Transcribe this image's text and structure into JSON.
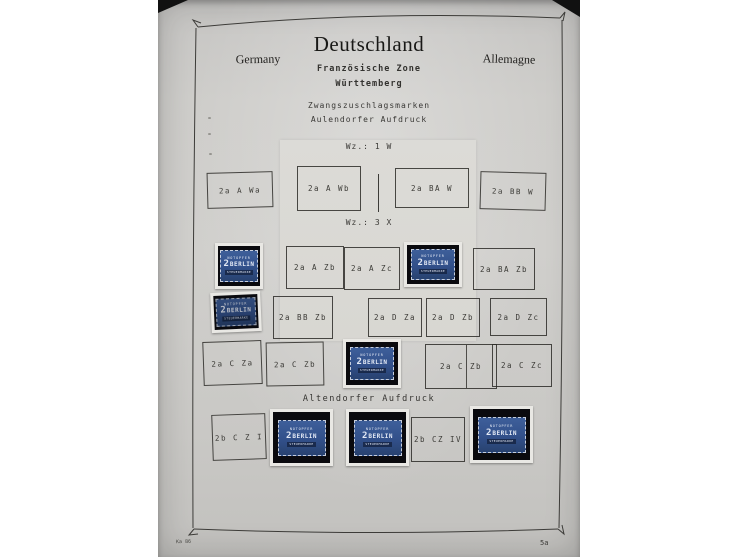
{
  "header": {
    "left_lang": "Germany",
    "title": "Deutschland",
    "right_lang": "Allemagne",
    "subtitle1": "Französische Zone",
    "subtitle2": "Württemberg"
  },
  "section": {
    "line1": "Zwangszuschlagsmarken",
    "line2": "Aulendorfer Aufdruck"
  },
  "watermark_labels": {
    "wm1": "Wz.: 1 W",
    "wm3": "Wz.: 3 X"
  },
  "altendorf_heading": "Altendorfer Aufdruck",
  "rows": {
    "r1": [
      {
        "type": "box",
        "label": "2a A Wa"
      },
      {
        "type": "box",
        "label": "2a A Wb"
      },
      {
        "type": "box",
        "label": "2a BA W"
      },
      {
        "type": "box",
        "label": "2a BB W"
      }
    ],
    "r2": [
      {
        "type": "stamp"
      },
      {
        "type": "box",
        "label": "2a A Zb"
      },
      {
        "type": "box",
        "label": "2a A Zc"
      },
      {
        "type": "stamp"
      },
      {
        "type": "box",
        "label": "2a BA Zb"
      }
    ],
    "r3": [
      {
        "type": "stamp"
      },
      {
        "type": "box",
        "label": "2a BB Zb"
      },
      {
        "type": "box",
        "label": "2a D Za"
      },
      {
        "type": "box",
        "label": "2a D Zb"
      },
      {
        "type": "box",
        "label": "2a D Zc"
      }
    ],
    "r4": [
      {
        "type": "box",
        "label": "2a C Za"
      },
      {
        "type": "box",
        "label": "2a C Zb"
      },
      {
        "type": "stamp"
      },
      {
        "type": "box",
        "label": "2a C Zb"
      },
      {
        "type": "box",
        "label": "2a C Zc"
      }
    ],
    "r5": [
      {
        "type": "box",
        "label": "2b C Z I"
      },
      {
        "type": "stamp"
      },
      {
        "type": "stamp"
      },
      {
        "type": "box",
        "label": "2b CZ IV"
      },
      {
        "type": "stamp"
      }
    ]
  },
  "stamp": {
    "top": "NOTOPFER",
    "value": "2",
    "name": "BERLIN",
    "bottom": "STEUERMARKE"
  },
  "footer": {
    "code": "Ka 86",
    "page": "5a"
  },
  "colors": {
    "page_gray": "#cccbc8",
    "overlay_sheet": "#dadad5",
    "ink": "#3c3b38",
    "stamp_blue": "#33518a",
    "mount_black": "#0a0a0e",
    "stamp_frame_white": "#e9e8e4"
  }
}
